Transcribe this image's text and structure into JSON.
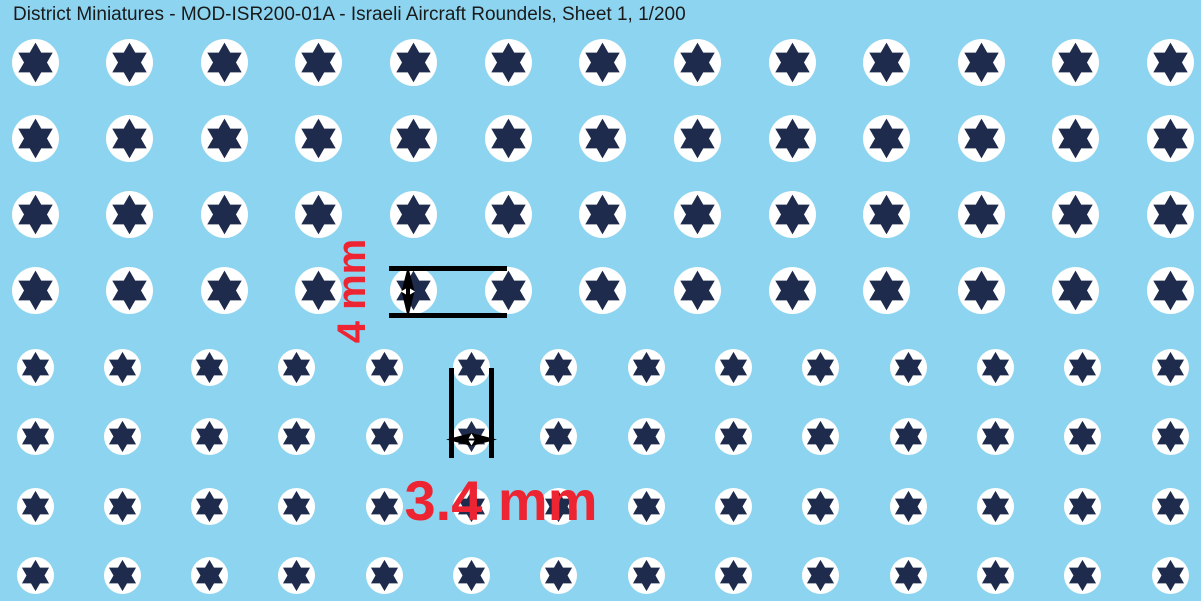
{
  "title": "District Miniatures - MOD-ISR200-01A - Israeli Aircraft Roundels, Sheet 1, 1/200",
  "colors": {
    "background": "#8DD4F0",
    "roundel_white": "#FFFFFF",
    "star_navy": "#1E2B4D",
    "annotation_red": "#ED2533",
    "annotation_black": "#000000",
    "title_text": "#1A1A1A"
  },
  "sheet": {
    "sections": [
      {
        "name": "roundels-4mm",
        "size_label": "4 mm",
        "rows": 4,
        "cols": 13,
        "diameter_px": 47,
        "start_x": 35,
        "start_y": 62,
        "spacing_x": 94.63,
        "spacing_y": 76.3
      },
      {
        "name": "roundels-3.4mm",
        "size_label": "3.4 mm",
        "rows": 4,
        "cols": 14,
        "diameter_px": 37,
        "start_x": 35,
        "start_y": 367,
        "spacing_x": 87.31,
        "spacing_y": 69.5
      }
    ]
  },
  "annotations": {
    "height_label": "4 mm",
    "width_label": "3.4 mm"
  }
}
